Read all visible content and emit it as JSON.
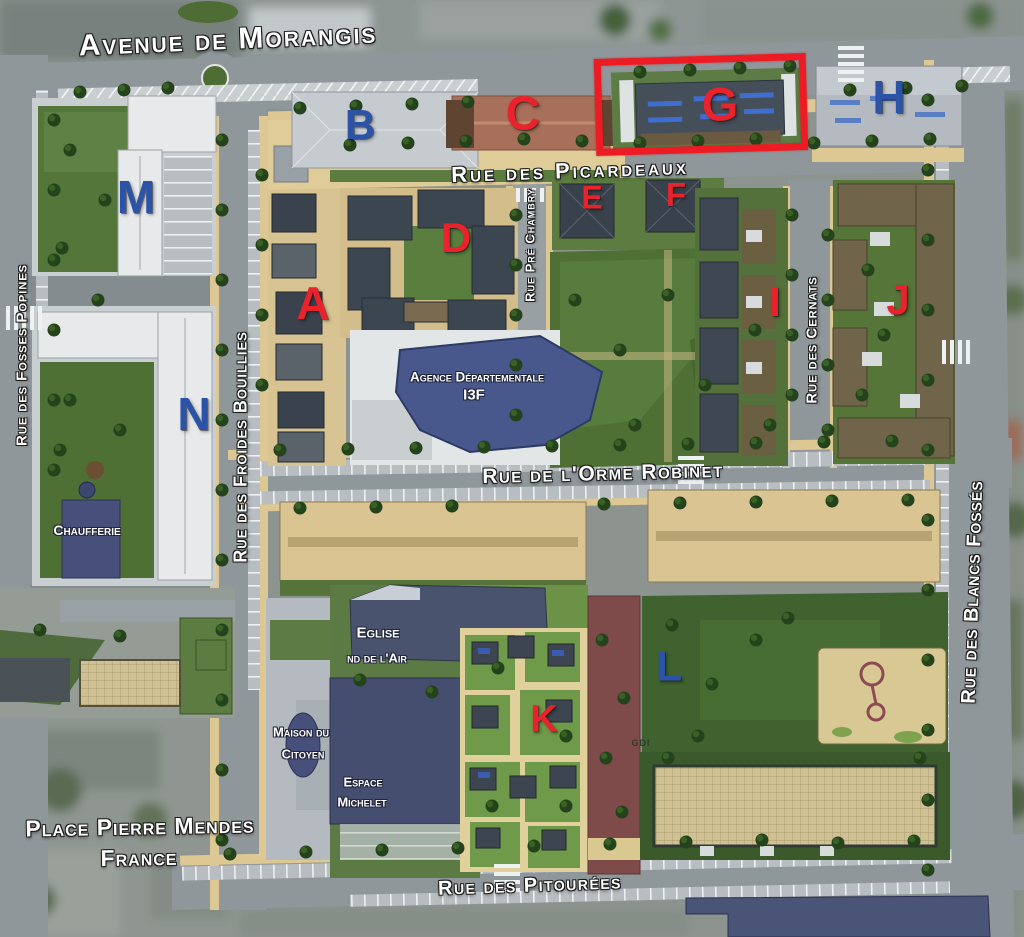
{
  "streets": {
    "avenue_de_morangis": "Avenue de Morangis",
    "rue_des_picardeaux": "Rue des Picardeaux",
    "rue_pre_chambry": "Rue Pré Chambry",
    "rue_de_lorme_robinet": "Rue de l'Orme Robinet",
    "rue_des_pitourees": "Rue des Pitourées",
    "rue_des_fosses_popines": "Rue des Fosses Popines",
    "rue_des_froides_bouillies": "Rue des Froides Bouillies",
    "rue_des_cernats": "Rue des Cernats",
    "rue_des_blancs_fosses": "Rue des Blancs Fossés"
  },
  "places": {
    "place_pierre_mendes_france": {
      "line1": "Place Pierre Mendes",
      "line2": "France"
    }
  },
  "facilities": {
    "chaufferie": "Chaufferie",
    "agence_departementale": {
      "line1": "Agence Départementale",
      "line2": "I3F"
    },
    "eglise_nd_de_lair": {
      "line1": "Eglise",
      "line2": "nd de l'Air"
    },
    "maison_du_citoyen": {
      "line1": "Maison du",
      "line2": "Citoyen"
    },
    "espace_michelet": {
      "line1": "Espace",
      "line2": "Michelet"
    },
    "gdi": "GDI"
  },
  "buildings": {
    "A": {
      "label": "A",
      "color": "red"
    },
    "B": {
      "label": "B",
      "color": "blue"
    },
    "C": {
      "label": "C",
      "color": "red"
    },
    "D": {
      "label": "D",
      "color": "red"
    },
    "E": {
      "label": "E",
      "color": "red"
    },
    "F": {
      "label": "F",
      "color": "red"
    },
    "G": {
      "label": "G",
      "color": "red",
      "highlighted": true
    },
    "H": {
      "label": "H",
      "color": "blue"
    },
    "I": {
      "label": "I",
      "color": "red"
    },
    "J": {
      "label": "J",
      "color": "red"
    },
    "K": {
      "label": "K",
      "color": "red"
    },
    "L": {
      "label": "L",
      "color": "blue"
    },
    "M": {
      "label": "M",
      "color": "blue"
    },
    "N": {
      "label": "N",
      "color": "blue"
    }
  },
  "highlight": {
    "type": "rectangle",
    "around_building": "G",
    "color": "#ed1c24"
  },
  "colors": {
    "building_letter_red": "#e8232b",
    "building_letter_blue": "#2b54a9",
    "street_label": "#ffffff",
    "highlight_rectangle": "#ed1c24"
  }
}
